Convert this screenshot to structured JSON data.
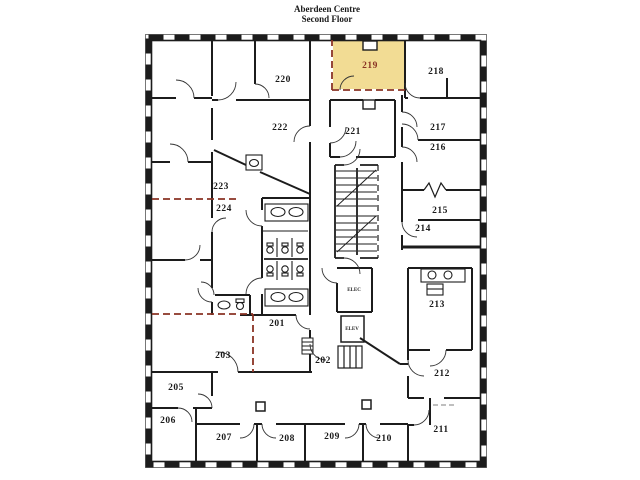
{
  "title": {
    "line1": "Aberdeen Centre",
    "line2": "Second Floor"
  },
  "floor_plan": {
    "building_name": "Aberdeen Centre",
    "floor_name": "Second Floor",
    "highlighted_room": "219",
    "colors": {
      "highlight_fill": "#f2dc94",
      "suite_boundary": "#8a3324",
      "wall": "#1c1c1c",
      "background": "#ffffff"
    },
    "rooms": [
      {
        "number": "201",
        "x": 277,
        "y": 324,
        "highlighted": false
      },
      {
        "number": "202",
        "x": 323,
        "y": 361,
        "highlighted": false
      },
      {
        "number": "203",
        "x": 223,
        "y": 356,
        "highlighted": false
      },
      {
        "number": "205",
        "x": 176,
        "y": 388,
        "highlighted": false
      },
      {
        "number": "206",
        "x": 168,
        "y": 421,
        "highlighted": false
      },
      {
        "number": "207",
        "x": 224,
        "y": 438,
        "highlighted": false
      },
      {
        "number": "208",
        "x": 287,
        "y": 439,
        "highlighted": false
      },
      {
        "number": "209",
        "x": 332,
        "y": 437,
        "highlighted": false
      },
      {
        "number": "210",
        "x": 384,
        "y": 439,
        "highlighted": false
      },
      {
        "number": "211",
        "x": 441,
        "y": 430,
        "highlighted": false
      },
      {
        "number": "212",
        "x": 442,
        "y": 374,
        "highlighted": false
      },
      {
        "number": "213",
        "x": 437,
        "y": 305,
        "highlighted": false
      },
      {
        "number": "214",
        "x": 423,
        "y": 229,
        "highlighted": false
      },
      {
        "number": "215",
        "x": 440,
        "y": 211,
        "highlighted": false
      },
      {
        "number": "216",
        "x": 438,
        "y": 148,
        "highlighted": false
      },
      {
        "number": "217",
        "x": 438,
        "y": 128,
        "highlighted": false
      },
      {
        "number": "218",
        "x": 436,
        "y": 72,
        "highlighted": false
      },
      {
        "number": "219",
        "x": 370,
        "y": 66,
        "highlighted": true
      },
      {
        "number": "220",
        "x": 283,
        "y": 80,
        "highlighted": false
      },
      {
        "number": "221",
        "x": 353,
        "y": 132,
        "highlighted": false
      },
      {
        "number": "222",
        "x": 280,
        "y": 128,
        "highlighted": false
      },
      {
        "number": "223",
        "x": 221,
        "y": 187,
        "highlighted": false
      },
      {
        "number": "224",
        "x": 224,
        "y": 209,
        "highlighted": false
      }
    ],
    "service_labels": [
      {
        "text": "ELEC",
        "x": 354,
        "y": 290
      },
      {
        "text": "ELEV",
        "x": 352,
        "y": 329
      }
    ]
  }
}
